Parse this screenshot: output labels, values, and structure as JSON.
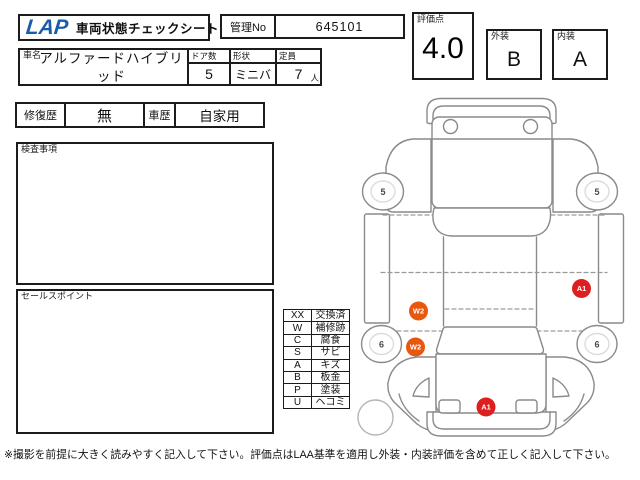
{
  "header": {
    "logo": "LAP",
    "title": "車両状態チェックシート",
    "manage_no": {
      "label": "管理No",
      "value": "645101"
    },
    "score": {
      "label": "評価点",
      "value": "4.0"
    },
    "exterior": {
      "label": "外装",
      "value": "B"
    },
    "interior": {
      "label": "内装",
      "value": "A"
    }
  },
  "vehicle": {
    "name": {
      "label": "車名",
      "value": "アルファードハイブリッド"
    },
    "doors": {
      "label": "ドア数",
      "value": "5"
    },
    "shape": {
      "label": "形状",
      "value": "ミニバ"
    },
    "capacity": {
      "label": "定員",
      "value": "7",
      "unit": "人"
    }
  },
  "history": {
    "repair": {
      "label": "修復歴",
      "value": "無"
    },
    "usage": {
      "label": "車歴",
      "value": "自家用"
    }
  },
  "sections": {
    "inspection_label": "検査事項",
    "sales_point_label": "セールスポイント"
  },
  "legend": {
    "rows": [
      {
        "code": "XX",
        "label": "交換済"
      },
      {
        "code": "W",
        "label": "補修跡"
      },
      {
        "code": "C",
        "label": "腐食"
      },
      {
        "code": "S",
        "label": "サビ"
      },
      {
        "code": "A",
        "label": "キズ"
      },
      {
        "code": "B",
        "label": "板金"
      },
      {
        "code": "P",
        "label": "塗装"
      },
      {
        "code": "U",
        "label": "ヘコミ"
      }
    ]
  },
  "diagram": {
    "wheel_marks": [
      {
        "position": "upper-left",
        "value": "5"
      },
      {
        "position": "upper-right",
        "value": "5"
      },
      {
        "position": "lower-left",
        "value": "6"
      },
      {
        "position": "lower-right",
        "value": "6"
      }
    ],
    "damage_marks": [
      {
        "code": "W2",
        "color": "#e8570e",
        "area": "left-side-center"
      },
      {
        "code": "W2",
        "color": "#e8570e",
        "area": "left-side-lower"
      },
      {
        "code": "A1",
        "color": "#dd1f1f",
        "area": "right-side-center"
      },
      {
        "code": "A1",
        "color": "#dd1f1f",
        "area": "bottom-center-panel"
      }
    ]
  },
  "footer": {
    "note": "※撮影を前提に大きく読みやすく記入して下さい。評価点はLAA基準を適用し外装・内装評価を含めて正しく記入して下さい。"
  },
  "colors": {
    "logo_blue": "#1b5ca8",
    "marker_orange": "#e8570e",
    "marker_red": "#dd1f1f",
    "outline_gray": "#8a8a8a"
  }
}
